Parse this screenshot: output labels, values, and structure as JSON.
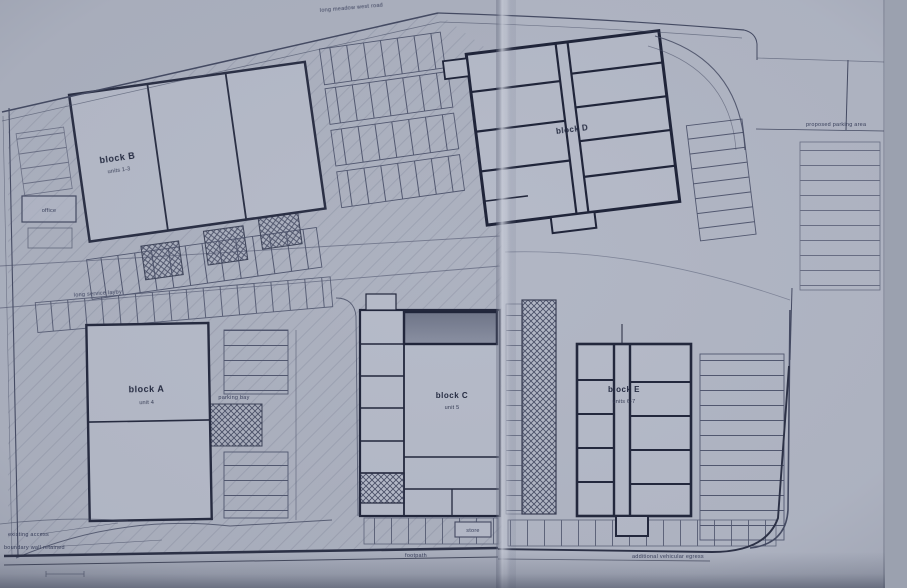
{
  "document": {
    "kind": "scanned architectural site plan",
    "pages": "two-page scan with centre fold seam"
  },
  "colors": {
    "paper": "#b2b7c5",
    "ink": "#454b63",
    "heavy_ink": "#262b3e",
    "hatch": "#8e94a6",
    "dark_room_fill": "#6f7588",
    "fold_highlight": "#c7cbd7",
    "scan_edge_band": "#9ba1af"
  },
  "blocks": {
    "b": {
      "label": "block B",
      "sub": "units 1-3"
    },
    "d": {
      "label": "block D",
      "sub": ""
    },
    "a": {
      "label": "block A",
      "sub": "unit 4"
    },
    "c": {
      "label": "block C",
      "sub": "unit 5"
    },
    "e": {
      "label": "block E",
      "sub": "units 6-7"
    }
  },
  "annotations": {
    "top_road": "long meadow west road",
    "right_note": "proposed parking area",
    "left_note": "long service layby",
    "center_note": "parking bay",
    "footpath": "footpath",
    "bottom_right_note": "additional vehicular egress",
    "corner_note_1": "existing access",
    "corner_note_2": "boundary wall retained",
    "office": "office",
    "store": "store"
  }
}
